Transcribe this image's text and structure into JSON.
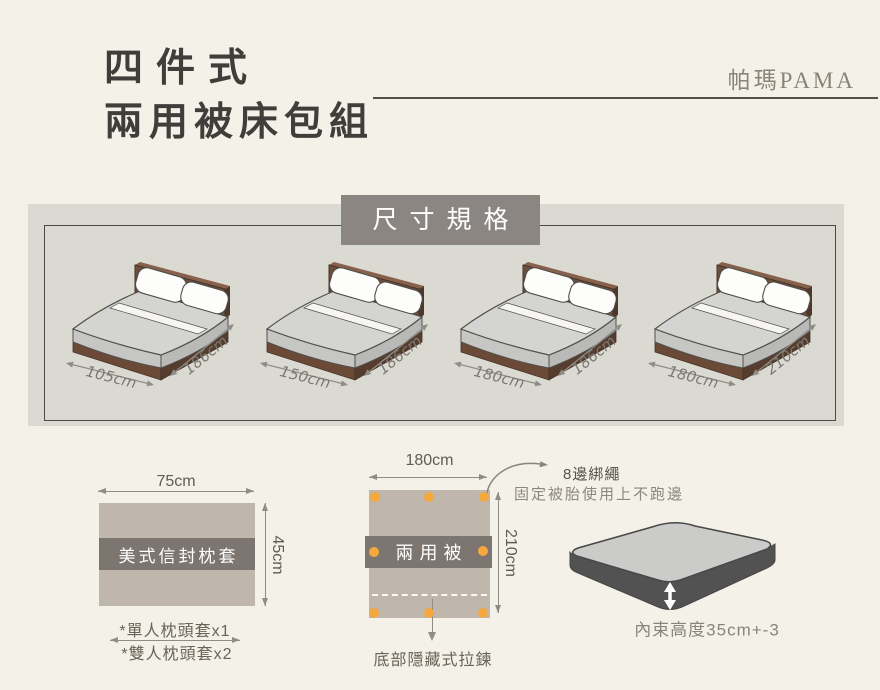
{
  "header": {
    "title_line1": "四件式",
    "title_line2": "兩用被床包組",
    "brand": "帕瑪PAMA"
  },
  "spec": {
    "box_title": "尺寸規格",
    "beds": [
      {
        "width": "105cm",
        "depth": "186cm"
      },
      {
        "width": "150cm",
        "depth": "186cm"
      },
      {
        "width": "180cm",
        "depth": "186cm"
      },
      {
        "width": "180cm",
        "depth": "210cm"
      }
    ]
  },
  "pillow": {
    "width_label": "75cm",
    "height_label": "45cm",
    "band_label": "美式信封枕套",
    "note1": "*單人枕頭套x1",
    "note2": "*雙人枕頭套x2"
  },
  "quilt": {
    "width_label": "180cm",
    "height_label": "210cm",
    "band_label": "兩用被",
    "tie_dot_count": 8,
    "tie_note_line1": "8邊綁繩",
    "tie_note_line2": "固定被胎使用上不跑邊",
    "zipper_note": "底部隱藏式拉鍊"
  },
  "mattress": {
    "height_note": "內束高度35cm+-3"
  },
  "colors": {
    "page_bg": "#f3f1e8",
    "spec_box_bg": "#dbdad2",
    "spec_title_bg": "#8c8682",
    "fabric_tan": "#bfb7ac",
    "band_gray": "#7d7670",
    "dot_orange": "#f5a83d",
    "wood_brown": "#6e4e3c",
    "mattress_gray": "#d4d4d2"
  }
}
